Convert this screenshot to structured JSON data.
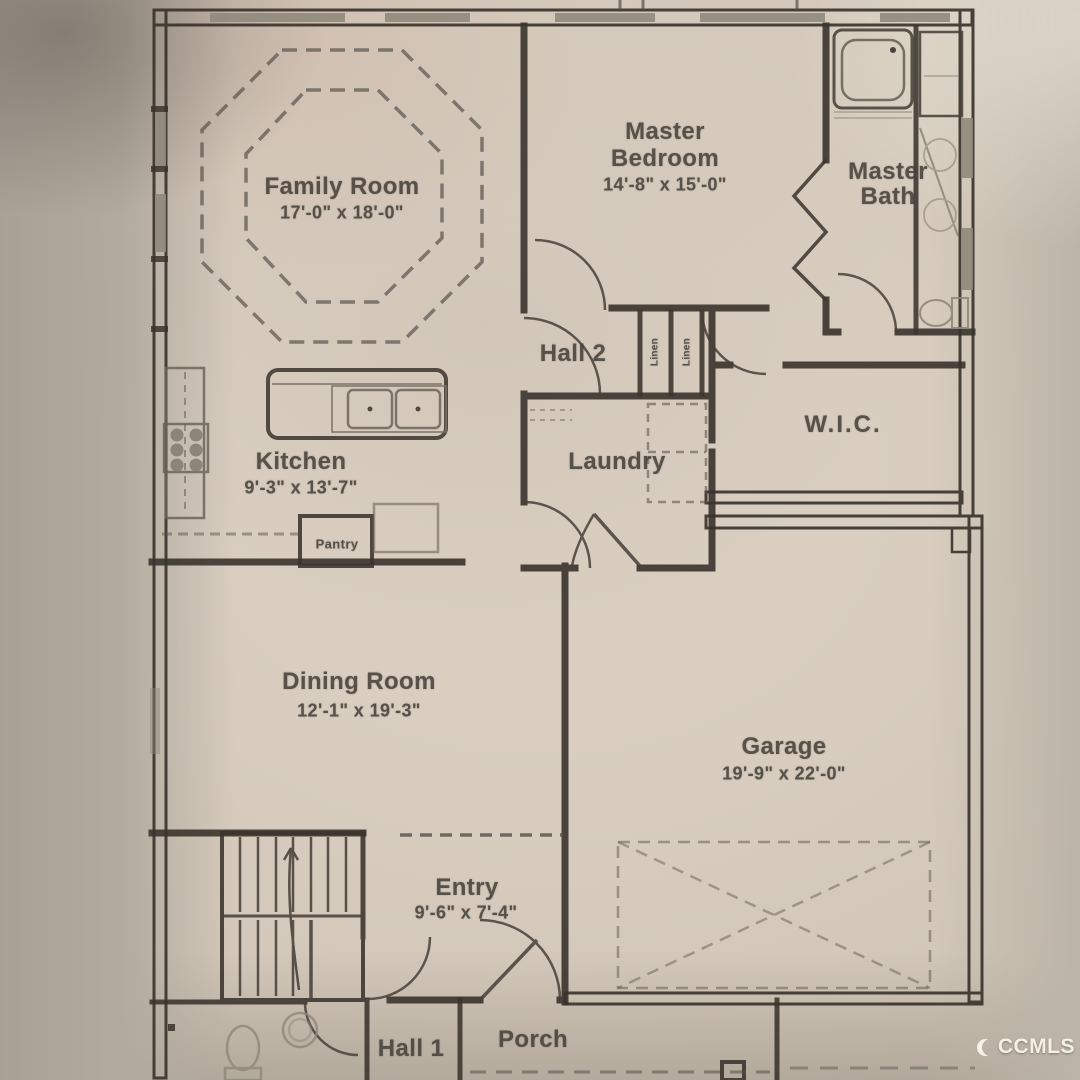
{
  "palette": {
    "paper": "#d9cec0",
    "margin_shadow": "#a9a196",
    "ink": "#3a342d",
    "ink_light": "#8e8779",
    "window_gray": "#8f897c"
  },
  "watermark": {
    "text": "CCMLS",
    "logo": "crescent-c"
  },
  "rooms": {
    "family_room": {
      "name": "Family Room",
      "dims": "17'-0\" x 18'-0\""
    },
    "master_bedroom": {
      "name_line1": "Master",
      "name_line2": "Bedroom",
      "dims": "14'-8\" x 15'-0\""
    },
    "master_bath": {
      "name_line1": "Master",
      "name_line2": "Bath"
    },
    "hall_2": {
      "name": "Hall 2"
    },
    "linen_left": {
      "name": "Linen"
    },
    "linen_right": {
      "name": "Linen"
    },
    "wic": {
      "name": "W.I.C."
    },
    "kitchen": {
      "name": "Kitchen",
      "dims": "9'-3\" x 13'-7\""
    },
    "pantry": {
      "name": "Pantry"
    },
    "laundry": {
      "name": "Laundry"
    },
    "dining_room": {
      "name": "Dining Room",
      "dims": "12'-1\" x 19'-3\""
    },
    "garage": {
      "name": "Garage",
      "dims": "19'-9\" x 22'-0\""
    },
    "entry": {
      "name": "Entry",
      "dims": "9'-6\" x 7'-4\""
    },
    "hall_1": {
      "name": "Hall 1"
    },
    "porch": {
      "name": "Porch"
    }
  }
}
